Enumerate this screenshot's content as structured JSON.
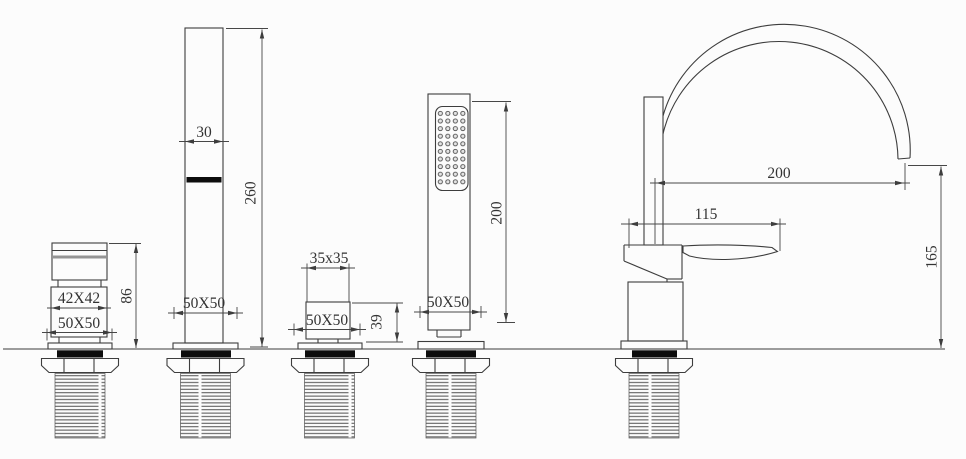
{
  "drawing": {
    "type": "technical-dimension-drawing",
    "subject": "4-hole bathtub faucet set with hand shower, front and side views",
    "background": "#fcfcfc",
    "line_color": "#3d3d3d",
    "labels": {
      "left_valve": {
        "body": "42X42",
        "base": "50X50",
        "height": "86"
      },
      "spout": {
        "width": "30",
        "height": "260",
        "base": "50X50"
      },
      "small_valve": {
        "head": "35x35",
        "base": "50X50",
        "height": "39"
      },
      "hand_shower": {
        "length": "200",
        "base": "50X50"
      },
      "side_faucet": {
        "reach": "200",
        "depth": "115",
        "outlet_height": "165"
      }
    }
  }
}
